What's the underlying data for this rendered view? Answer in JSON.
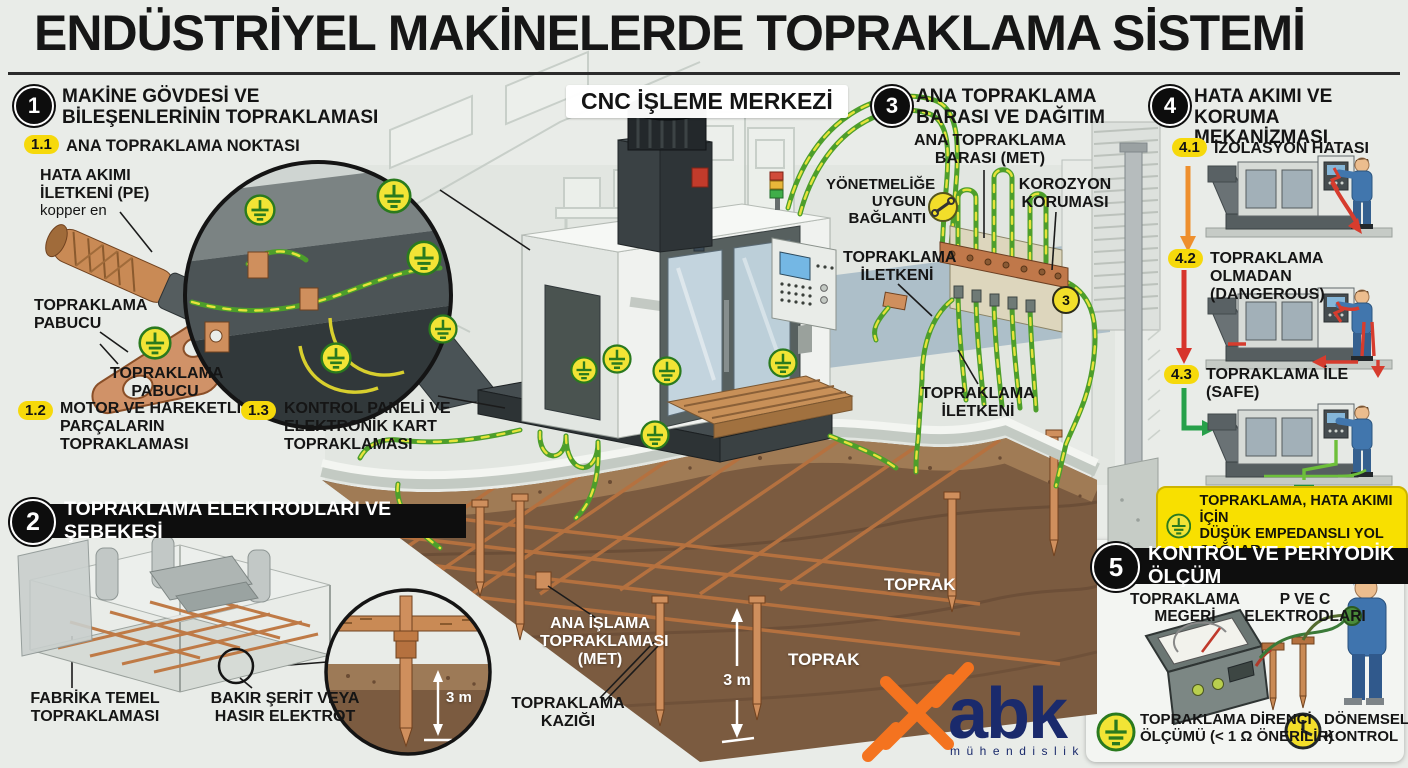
{
  "title": "ENDÜSTRİYEL MAKİNELERDE TOPRAKLAMA SİSTEMİ",
  "scene": {
    "cnc_title": "CNC İŞLEME MERKEZİ",
    "met_label": "ANA İŞLAMA\nTOPRAKLAMASI\n(MET)",
    "rod_label": "TOPRAKLAMA\nKAZIĞI",
    "soil_a": "TOPRAK",
    "soil_b": "TOPRAK",
    "depth": "3 m"
  },
  "sections": {
    "s1": {
      "num": "1",
      "title": "MAKİNE GÖVDESİ VE\nBİLEŞENLERİNİN TOPRAKLAMASI",
      "items": [
        {
          "num": "1.1",
          "label": "ANA TOPRAKLAMA NOKTASI"
        },
        {
          "num": "1.2",
          "label": "MOTOR VE HAREKETLİ\nPARÇALARIN\nTOPRAKLAMASI"
        },
        {
          "num": "1.3",
          "label": "KONTROL PANELİ VE\nELEKTRONİK KART\nTOPRAKLAMASI"
        }
      ],
      "labels": {
        "pe": "HATA AKIMI\nİLETKENİ (PE)",
        "pe_note": "kopper en",
        "lug_a": "TOPRAKLAMA\nPABUCU",
        "lug_b": "TOPRAKLAMA\nPABUCU"
      }
    },
    "s2": {
      "num": "2",
      "title": "TOPRAKLAMA ELEKTRODLARI VE ŞEBEKESİ",
      "labels": {
        "foundation": "FABRİKA TEMEL\nTOPRAKLAMASI",
        "electrode": "BAKIR ŞERİT VEYA\nHASIR ELEKTROT",
        "depth": "3 m"
      }
    },
    "s3": {
      "num": "3",
      "title": "ANA TOPRAKLAMA\nBARASI VE DAĞITIM",
      "labels": {
        "bus": "ANA TOPRAKLAMA\nBARASI (MET)",
        "corrosion": "KOROZYON\nKORUMASI",
        "regulation": "YÖNETMELİĞE\nUYGUN\nBAĞLANTI",
        "conductor_a": "TOPRAKLAMA\nİLETKENİ",
        "conductor_b": "TOPRAKLAMA\nİLETKENİ",
        "badge": "3"
      }
    },
    "s4": {
      "num": "4",
      "title": "HATA AKIMI VE\nKORUMA MEKANİZMASI",
      "steps": [
        {
          "num": "4.1",
          "label": "İZOLASYON HATASI"
        },
        {
          "num": "4.2",
          "label": "TOPRAKLAMA OLMADAN\n(DANGEROUS)"
        },
        {
          "num": "4.3",
          "label": "TOPRAKLAMA İLE\n(SAFE)"
        }
      ],
      "note": "TOPRAKLAMA, HATA AKIMI İÇİN\nDÜŞÜK EMPEDANSLI YOL SAĞLAR"
    },
    "s5": {
      "num": "5",
      "title": "KONTROL VE PERİYODİK ÖLÇÜM",
      "labels": {
        "megger": "TOPRAKLAMA\nMEGERİ",
        "electrodes": "P VE C\nELEKTRODLARI",
        "resistance": "TOPRAKLAMA DİRENCİ\nÖLÇÜMÜ (< 1 Ω ÖNERİLİR)",
        "periodic": "DÖNEMSEL\nKONTROL"
      }
    }
  },
  "logo": {
    "name": "abk",
    "sub": "mühendislik"
  },
  "colors": {
    "accent_yellow": "#F6D90B",
    "wire_green": "#4D9E2B",
    "wire_yellow": "#E6E33A",
    "copper": "#C9855C",
    "soil": "#7B5B40",
    "danger_red": "#D7342B",
    "warn_orange": "#EE8F2D",
    "safe_green": "#27A04A",
    "logo_orange": "#F4731F",
    "logo_navy": "#1A2A6C"
  }
}
